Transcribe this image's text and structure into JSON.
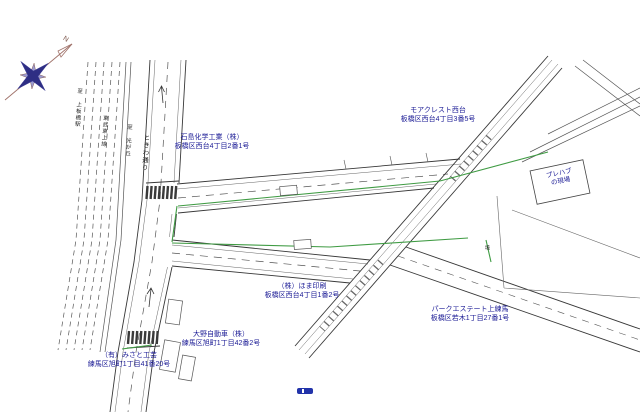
{
  "page": {
    "background": "#ffffff"
  },
  "palette": {
    "line": "#4a4a4a",
    "road_edge": "#383838",
    "green_boundary": "#3f9b43",
    "label_blue": "#1c1c96",
    "compass_navy": "#2e2e84",
    "compass_accent": "#a0726a"
  },
  "compass": {
    "label": "N"
  },
  "roads": {
    "main_road_name": "ときわ通り",
    "main_road_direction": "至 光が丘",
    "railway_name": "東武東上線",
    "railway_direction": "至 上板橋駅",
    "boundary_label": "境"
  },
  "sites": [
    {
      "name": "石島化学工業（株）",
      "address": "板橋区西台4丁目2番1号"
    },
    {
      "name": "モアクレスト西台",
      "address": "板橋区西台4丁目3番5号"
    },
    {
      "name": "（株）ほま印刷",
      "address": "板橋区西台4丁目1番2号"
    },
    {
      "name": "パークエステート上練馬",
      "address": "板橋区若木1丁目27番1号"
    },
    {
      "name": "大野自動車（株）",
      "address": "練馬区旭町1丁目42番2号"
    },
    {
      "name": "（有）みさと工芸",
      "address": "練馬区旭町1丁目41番20号"
    }
  ],
  "prefab": {
    "line1": "プレハブ",
    "line2": "の現場"
  }
}
